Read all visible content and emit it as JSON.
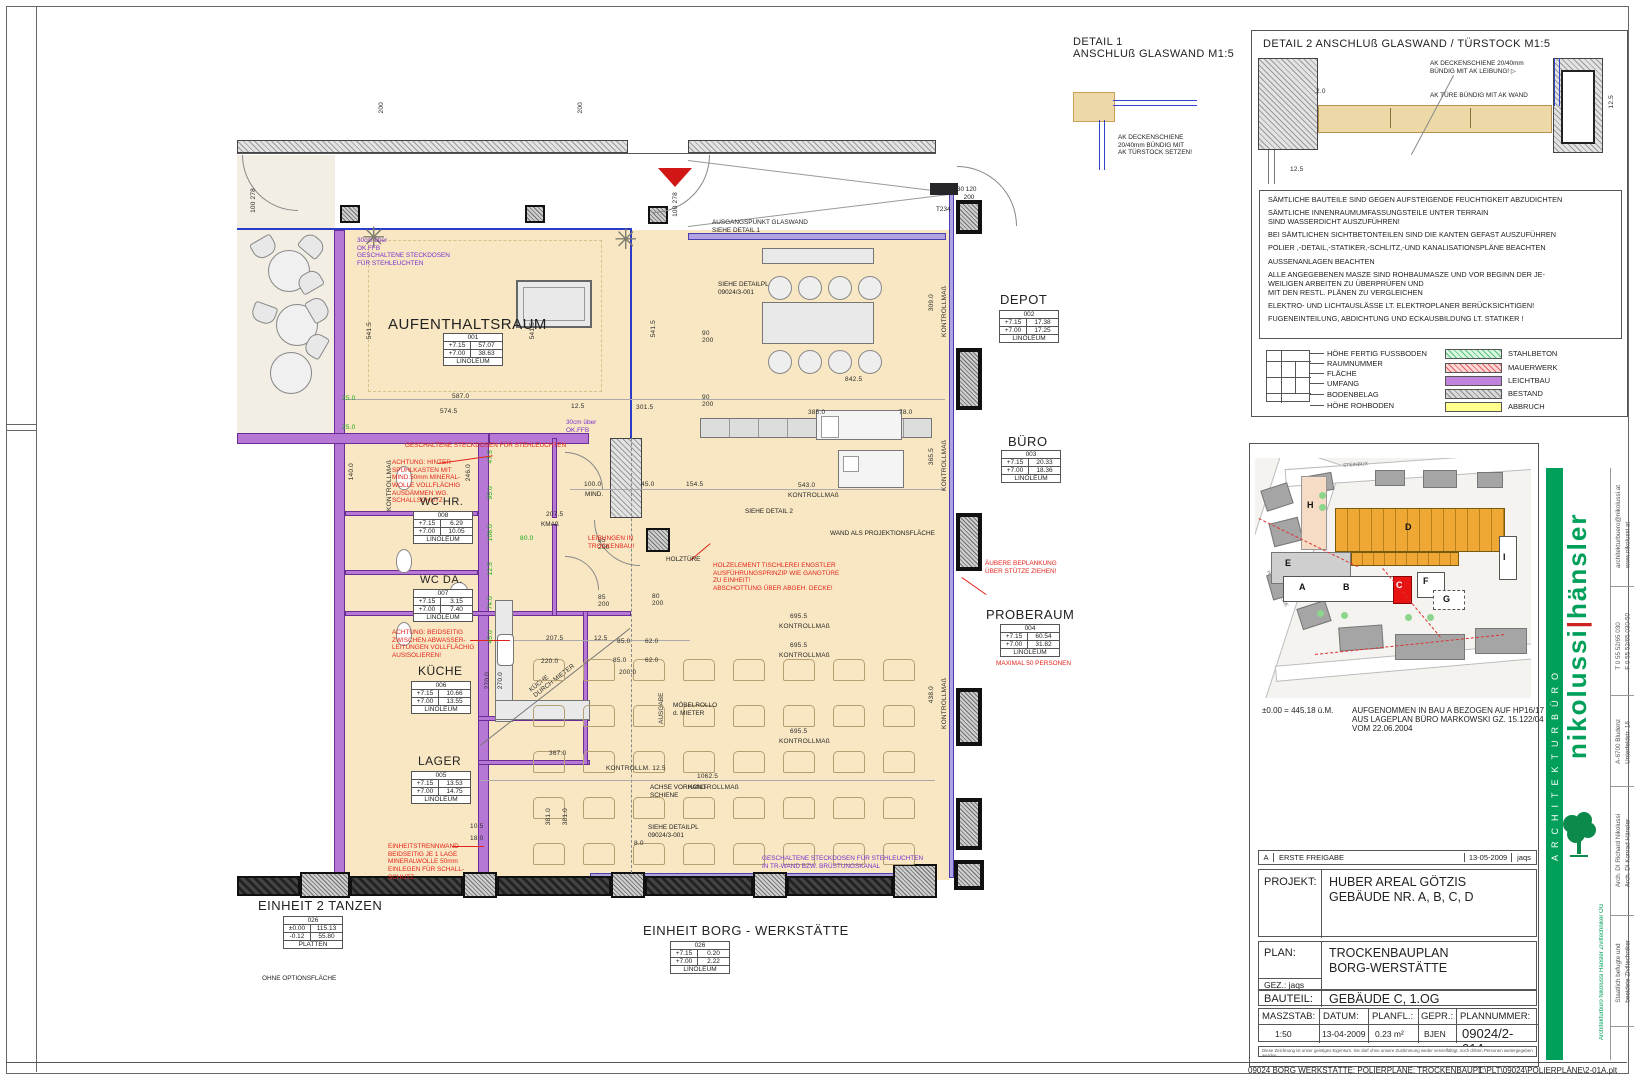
{
  "detail1": {
    "title": "DETAIL 1",
    "subtitle": "ANSCHLUß GLASWAND M1:5",
    "note": "AK DECKENSCHIENE\n20/40mm BÜNDIG MIT\nAK TÜRSTOCK SETZEN!"
  },
  "detail2": {
    "title": "DETAIL 2  ANSCHLUß GLASWAND / TÜRSTOCK  M1:5",
    "note1": "AK DECKENSCHIENE 20/40mm\nBÜNDIG MIT AK LEIBUNG!",
    "note2": "AK TÜRE BÜNDIG MIT AK WAND",
    "dim_a": "2.0",
    "dim_b": "12.5",
    "dim_c": "12.5"
  },
  "general_notes": [
    "SÄMTLICHE BAUTEILE SIND GEGEN AUFSTEIGENDE FEUCHTIGKEIT ABZUDICHTEN",
    "SÄMTLICHE INNENRAUMUMFASSUNGSTEILE UNTER TERRAIN\nSIND WASSERDICHT AUSZUFÜHREN!",
    "BEI SÄMTLICHEN SICHTBETONTEILEN SIND DIE KANTEN GEFAST AUSZUFÜHREN",
    "POLIER ,-DETAIL,-STATIKER,-SCHLITZ,-UND KANALISATIONSPLÄNE BEACHTEN",
    "AUSSENANLAGEN BEACHTEN",
    "ALLE ANGEGEBENEN MASZE SIND ROHBAUMASZE UND VOR BEGINN DER JE-\nWEILIGEN ARBEITEN ZU ÜBERPRÜFEN UND\nMIT DEN RESTL. PLÄNEN ZU VERGLEICHEN",
    "ELEKTRO- UND LICHTAUSLÄSSE LT. ELEKTROPLANER BERÜCKSICHTIGEN!",
    "FUGENEINTEILUNG, ABDICHTUNG UND ECKAUSBILDUNG LT. STATIKER !"
  ],
  "legend": {
    "callouts": [
      "HÖHE FERTIG FUSSBODEN",
      "RAUMNUMMER",
      "FLÄCHE",
      "UMFANG",
      "BODENBELAG",
      "HÖHE ROHBODEN"
    ],
    "materials": [
      {
        "label": "STAHLBETON",
        "style": "green-hatch",
        "color": "#d9f7e0"
      },
      {
        "label": "MAUERWERK",
        "style": "red-hatch",
        "color": "#fad6d6"
      },
      {
        "label": "LEICHTBAU",
        "style": "solid",
        "color": "#c184dd"
      },
      {
        "label": "BESTAND",
        "style": "gray-hatch",
        "color": "#d9d9d9"
      },
      {
        "label": "ABBRUCH",
        "style": "solid",
        "color": "#ffff8c"
      }
    ]
  },
  "site": {
    "datum": "±0.00 = 445.18 ü.M.",
    "note": "AUFGENOMMEN IN BAU A BEZOGEN AUF HP16/17\nAUS LAGEPLAN BÜRO MARKOWSKI GZ. 15.122/04\nVOM 22.06.2004",
    "buildings": [
      "H",
      "E",
      "A",
      "B",
      "C",
      "D",
      "F",
      "G",
      "I"
    ],
    "street1": "STEINBUX",
    "street2": "HAUPTSTRASSE"
  },
  "revision": {
    "rev": "A",
    "desc": "ERSTE FREIGABE",
    "date": "13-05-2009",
    "by": "jaqs"
  },
  "titleblock": {
    "projekt_label": "PROJEKT:",
    "projekt1": "HUBER AREAL GÖTZIS",
    "projekt2": "GEBÄUDE NR. A, B, C, D",
    "plan_label": "PLAN:",
    "plan1": "TROCKENBAUPLAN",
    "plan2": "BORG-WERSTÄTTE",
    "gez_label": "GEZ.:",
    "gez": "jaqs",
    "bauteil_label": "BAUTEIL:",
    "bauteil": "GEBÄUDE C, 1.OG",
    "masz_label": "MASZSTAB:",
    "masz": "1:50",
    "datum_label": "DATUM:",
    "datum": "13-04-2009",
    "planfl_label": "PLANFL.:",
    "planfl": "0.23 m²",
    "gepr_label": "GEPR.:",
    "gepr": "BJEN",
    "plannr_label": "PLANNUMMER:",
    "plannr": "09024/2-01A",
    "disclaimer": "Diese Zeichnung ist unser geistiges Eigentum. Sie darf ohne unsere Zustimmung weder vervielfältigt, noch dritten Personen weitergegeben werden."
  },
  "firm": {
    "bar": "ARCHITEKTURBÜRO",
    "name1": "nikolussi",
    "name2": "hänsler",
    "info": [
      "architekturbuero@nikolussi.at\nwww.nikolussi.at",
      "T 0 55 52/65 030\nF 0 55 52/65 030-50",
      "A-6700 Bludenz\nUnterfeldstr. 16",
      "Arch. DI Richard Nikolussi\nArch. DI Konrad Hänsler",
      "Staatlich befugte und\nbeeidete Ziviltechniker"
    ],
    "og": "Architekturbüro Nikolussi Hänsler Ziviltechniker OG",
    "accent": "#00a05a"
  },
  "footer": {
    "left": "09024 BORG WERKSTÄTTE: POLIERPLÄNE: TROCKENBAUPL",
    "right": "T:\\PLT\\09024\\POLIERPLÄNE\\2-01A.plt"
  },
  "plan": {
    "stamps": [
      {
        "tx": 388,
        "ty": 316,
        "fs": 15,
        "x": 443,
        "y": 333,
        "name": "AUFENTHALTSRAUM",
        "num": "001",
        "a1": "+7.15",
        "b1": "57.07",
        "a2": "+7.00",
        "b2": "38.63",
        "belag": "LINOLEUM"
      },
      {
        "tx": 1000,
        "ty": 292,
        "fs": 13,
        "x": 999,
        "y": 310,
        "name": "DEPOT",
        "num": "002",
        "a1": "+7.15",
        "b1": "17.38",
        "a2": "+7.00",
        "b2": "17.25",
        "belag": "LINOLEUM"
      },
      {
        "tx": 1008,
        "ty": 434,
        "fs": 13,
        "x": 1001,
        "y": 450,
        "name": "BÜRO",
        "num": "003",
        "a1": "+7.15",
        "b1": "20.33",
        "a2": "+7.00",
        "b2": "18.36",
        "belag": "LINOLEUM"
      },
      {
        "tx": 986,
        "ty": 607,
        "fs": 13,
        "x": 1000,
        "y": 624,
        "name": "PROBERAUM",
        "num": "004",
        "a1": "+7.15",
        "b1": "60.54",
        "a2": "+7.00",
        "b2": "31.82",
        "belag": "LINOLEUM"
      },
      {
        "tx": 420,
        "ty": 496,
        "fs": 11,
        "x": 413,
        "y": 511,
        "name": "WC HR.",
        "num": "008",
        "a1": "+7.15",
        "b1": "6.29",
        "a2": "+7.00",
        "b2": "10.05",
        "belag": "LINOLEUM"
      },
      {
        "tx": 420,
        "ty": 574,
        "fs": 11,
        "x": 413,
        "y": 589,
        "name": "WC DA.",
        "num": "007",
        "a1": "+7.15",
        "b1": "3.15",
        "a2": "+7.00",
        "b2": "7.40",
        "belag": "LINOLEUM"
      },
      {
        "tx": 418,
        "ty": 664,
        "fs": 12,
        "x": 411,
        "y": 681,
        "name": "KÜCHE",
        "num": "006",
        "a1": "+7.15",
        "b1": "10.66",
        "a2": "+7.00",
        "b2": "13.55",
        "belag": "LINOLEUM"
      },
      {
        "tx": 418,
        "ty": 754,
        "fs": 12,
        "x": 411,
        "y": 771,
        "name": "LAGER",
        "num": "005",
        "a1": "+7.15",
        "b1": "13.53",
        "a2": "+7.00",
        "b2": "14.75",
        "belag": "LINOLEUM"
      },
      {
        "tx": 258,
        "ty": 898,
        "fs": 13,
        "x": 283,
        "y": 916,
        "name": "EINHEIT 2 TANZEN",
        "num": "026",
        "a1": "±0.00",
        "b1": "115.13",
        "a2": "-0.12",
        "b2": "55.80",
        "belag": "PLATTEN"
      },
      {
        "tx": 643,
        "ty": 923,
        "fs": 13,
        "x": 670,
        "y": 941,
        "name": "EINHEIT BORG - WERKSTÄTTE",
        "num": "026",
        "a1": "+7.15",
        "b1": "0.20",
        "a2": "+7.00",
        "b2": "2.22",
        "belag": "LINOLEUM"
      }
    ],
    "notes": [
      {
        "x": 357,
        "y": 237,
        "c": "pur",
        "t": "30cm über\nOK.FFB\nGESCHALTENE STECKDOSEN\nFÜR STEHLEUCHTEN"
      },
      {
        "x": 566,
        "y": 419,
        "c": "pur",
        "t": "30cm über\nOK.FFB"
      },
      {
        "x": 405,
        "y": 442,
        "c": "red",
        "t": "GESCHALTENE STECKDOSEN FÜR STEHLEUCHTEN"
      },
      {
        "x": 392,
        "y": 459,
        "c": "red",
        "t": "ACHTUNG: HINTER\nSPÜHLKASTEN MIT\nMIND.50mm MINERAL-\nWOLLE VOLLFLÄCHIG\nAUSDÄMMEN WG.\nSCHALLSCHUTZ"
      },
      {
        "x": 392,
        "y": 629,
        "c": "red",
        "t": "ACHTUNG: BEIDSEITIG\nZWISCHEN ABWASSER-\nLEITUNGEN VOLLFLÄCHIG\nAUSISOLIEREN!"
      },
      {
        "x": 388,
        "y": 843,
        "c": "red",
        "t": "EINHEITSTRENNWAND\nBEIDSEITIG JE 1 LAGE\nMINERALWOLLE 50mm\nEINLEGEN FÜR SCHALL-\nSCHUTZ"
      },
      {
        "x": 588,
        "y": 535,
        "c": "red",
        "t": "LEIBUNGEN IN\nTROCKENBAU!"
      },
      {
        "x": 713,
        "y": 562,
        "c": "red",
        "t": "HOLZELEMENT TISCHLEREI ENGSTLER\nAUSFÜHRUNGSPRINZIP WIE GANGTÜRE\nZU EINHEIT!\nABSCHOTTUNG ÜBER ABGEH. DECKE!"
      },
      {
        "x": 985,
        "y": 560,
        "c": "red",
        "t": "ÄUBERE BEPLANKUNG\nÜBER STÜTZE ZIEHEN!"
      },
      {
        "x": 996,
        "y": 660,
        "c": "red",
        "t": "MAXIMAL 50 PERSONEN"
      },
      {
        "x": 762,
        "y": 855,
        "c": "pur",
        "t": "GESCHALTENE STECKDOSEN FÜR STEHLEUCHTEN\nIN TR-WAND BZW. BRÜSTUNGSKANAL"
      },
      {
        "x": 712,
        "y": 219,
        "c": "blk",
        "t": "AUSGANGSPUNKT GLASWAND\nSIEHE DETAIL 1"
      },
      {
        "x": 718,
        "y": 281,
        "c": "blk",
        "t": "SIEHE DETAILPL\n09024/3-001"
      },
      {
        "x": 745,
        "y": 508,
        "c": "blk",
        "t": "SIEHE DETAIL 2"
      },
      {
        "x": 666,
        "y": 556,
        "c": "blk",
        "t": "HOLZTÜRE"
      },
      {
        "x": 830,
        "y": 530,
        "c": "blk",
        "t": "WAND ALS PROJEKTIONSFLÄCHE"
      },
      {
        "x": 650,
        "y": 784,
        "c": "blk",
        "t": "ACHSE VORHANG-\nSCHIENE"
      },
      {
        "x": 648,
        "y": 824,
        "c": "blk",
        "t": "SIEHE DETAILPL\n09024/3-001"
      },
      {
        "x": 673,
        "y": 702,
        "c": "blk",
        "t": "MÖBELROLLO\nd. MIETER"
      },
      {
        "x": 262,
        "y": 975,
        "c": "blk",
        "t": "OHNE OPTIONSFLÄCHE"
      },
      {
        "x": 953,
        "y": 186,
        "c": "blk",
        "t": "T30 120\n      200"
      },
      {
        "x": 936,
        "y": 206,
        "c": "blk",
        "t": "T234"
      },
      {
        "x": 585,
        "y": 491,
        "c": "blk",
        "t": "MIND."
      },
      {
        "x": 541,
        "y": 521,
        "c": "blk",
        "t": "KMAß"
      }
    ],
    "dims": [
      {
        "x": 452,
        "y": 393,
        "t": "587.0"
      },
      {
        "x": 440,
        "y": 408,
        "t": "574.5"
      },
      {
        "x": 845,
        "y": 376,
        "t": "842.5"
      },
      {
        "x": 636,
        "y": 404,
        "t": "301.5"
      },
      {
        "x": 571,
        "y": 403,
        "t": "12.5"
      },
      {
        "x": 808,
        "y": 409,
        "t": "385.0"
      },
      {
        "x": 899,
        "y": 409,
        "t": "78.0"
      },
      {
        "x": 798,
        "y": 482,
        "t": "543.0"
      },
      {
        "x": 788,
        "y": 492,
        "t": "KONTROLLMAß"
      },
      {
        "x": 584,
        "y": 481,
        "t": "100.0"
      },
      {
        "x": 641,
        "y": 481,
        "t": "45.0"
      },
      {
        "x": 686,
        "y": 481,
        "t": "154.5"
      },
      {
        "x": 790,
        "y": 613,
        "t": "695.5"
      },
      {
        "x": 779,
        "y": 623,
        "t": "KONTROLLMAß"
      },
      {
        "x": 790,
        "y": 642,
        "t": "695.5"
      },
      {
        "x": 779,
        "y": 652,
        "t": "KONTROLLMAß"
      },
      {
        "x": 790,
        "y": 728,
        "t": "695.5"
      },
      {
        "x": 779,
        "y": 738,
        "t": "KONTROLLMAß"
      },
      {
        "x": 697,
        "y": 773,
        "t": "1062.5"
      },
      {
        "x": 688,
        "y": 784,
        "t": "KONTROLLMAß"
      },
      {
        "x": 606,
        "y": 765,
        "t": "KONTROLLM. 12.5"
      },
      {
        "x": 546,
        "y": 635,
        "t": "207.5"
      },
      {
        "x": 541,
        "y": 658,
        "t": "220.0"
      },
      {
        "x": 617,
        "y": 638,
        "t": "85.0"
      },
      {
        "x": 645,
        "y": 638,
        "t": "62.0"
      },
      {
        "x": 613,
        "y": 657,
        "t": "85.0"
      },
      {
        "x": 645,
        "y": 657,
        "t": "62.0"
      },
      {
        "x": 619,
        "y": 669,
        "t": "200.0"
      },
      {
        "x": 594,
        "y": 635,
        "t": "12.5"
      },
      {
        "x": 546,
        "y": 511,
        "t": "207.5"
      },
      {
        "x": 549,
        "y": 750,
        "t": "367.0"
      },
      {
        "x": 634,
        "y": 840,
        "t": "8.0"
      },
      {
        "x": 470,
        "y": 823,
        "t": "10.5"
      },
      {
        "x": 470,
        "y": 835,
        "t": "18.0"
      },
      {
        "x": 702,
        "y": 330,
        "t": "90\n200"
      },
      {
        "x": 702,
        "y": 394,
        "t": "90\n200"
      },
      {
        "x": 598,
        "y": 537,
        "t": "85\n200"
      },
      {
        "x": 598,
        "y": 594,
        "t": "85\n200"
      },
      {
        "x": 652,
        "y": 593,
        "t": "80\n200"
      },
      {
        "x": 250,
        "y": 188,
        "t": "100 278",
        "v": 1
      },
      {
        "x": 672,
        "y": 192,
        "t": "100 278",
        "v": 1
      },
      {
        "x": 366,
        "y": 322,
        "t": "541.5",
        "v": 1
      },
      {
        "x": 529,
        "y": 322,
        "t": "541.5",
        "v": 1
      },
      {
        "x": 650,
        "y": 320,
        "t": "541.5",
        "v": 1
      },
      {
        "x": 928,
        "y": 294,
        "t": "309.0",
        "v": 1
      },
      {
        "x": 941,
        "y": 286,
        "t": "KONTROLLMAß",
        "v": 1
      },
      {
        "x": 928,
        "y": 448,
        "t": "365.5",
        "v": 1
      },
      {
        "x": 941,
        "y": 440,
        "t": "KONTROLLMAß",
        "v": 1
      },
      {
        "x": 928,
        "y": 686,
        "t": "438.0",
        "v": 1
      },
      {
        "x": 941,
        "y": 678,
        "t": "KONTROLLMAß",
        "v": 1
      },
      {
        "x": 386,
        "y": 460,
        "t": "KONTROLLMAß",
        "v": 1
      },
      {
        "x": 348,
        "y": 463,
        "t": "140.0",
        "v": 1
      },
      {
        "x": 545,
        "y": 808,
        "t": "381.0",
        "v": 1
      },
      {
        "x": 562,
        "y": 808,
        "t": "381.0",
        "v": 1
      },
      {
        "x": 484,
        "y": 672,
        "t": "270.0",
        "v": 1
      },
      {
        "x": 497,
        "y": 672,
        "t": "270.0",
        "v": 1
      },
      {
        "x": 465,
        "y": 464,
        "t": "246.0",
        "v": 1
      },
      {
        "x": 465,
        "y": 590,
        "t": "120.0",
        "v": 1
      },
      {
        "x": 378,
        "y": 102,
        "t": "200",
        "v": 1
      },
      {
        "x": 577,
        "y": 102,
        "t": "200",
        "v": 1
      },
      {
        "x": 520,
        "y": 535,
        "t": "80.0",
        "g": 1
      },
      {
        "x": 342,
        "y": 395,
        "t": "25.0",
        "g": 1
      },
      {
        "x": 342,
        "y": 424,
        "t": "25.0",
        "g": 1
      },
      {
        "x": 487,
        "y": 450,
        "t": "47.5",
        "v": 1,
        "g": 1
      },
      {
        "x": 487,
        "y": 486,
        "t": "95.0",
        "v": 1,
        "g": 1
      },
      {
        "x": 487,
        "y": 524,
        "t": "108.0",
        "v": 1,
        "g": 1
      },
      {
        "x": 487,
        "y": 562,
        "t": "12.5",
        "v": 1,
        "g": 1
      },
      {
        "x": 487,
        "y": 596,
        "t": "74.0",
        "v": 1,
        "g": 1
      },
      {
        "x": 487,
        "y": 630,
        "t": "45.0",
        "v": 1,
        "g": 1
      }
    ]
  }
}
